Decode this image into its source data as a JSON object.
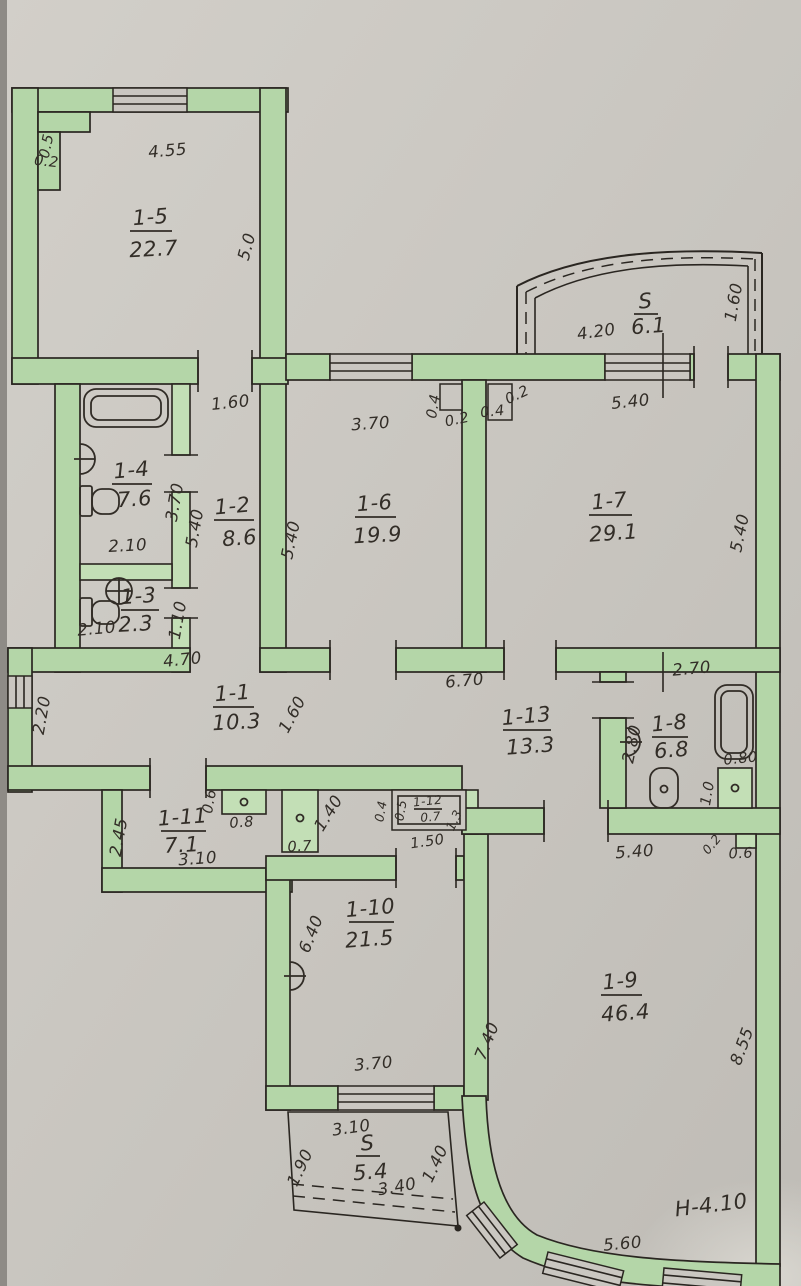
{
  "plan": {
    "type": "apartment-floor-plan",
    "note": "H-4.10",
    "colors": {
      "paper": "#cac7c1",
      "wall_green": "#b4d6a8",
      "ink": "#2a2621"
    }
  },
  "rooms": [
    {
      "id": "1-5",
      "area": "22.7"
    },
    {
      "id": "1-4",
      "area": "7.6"
    },
    {
      "id": "1-2",
      "area": "8.6"
    },
    {
      "id": "1-3",
      "area": "2.3"
    },
    {
      "id": "1-6",
      "area": "19.9"
    },
    {
      "id": "1-7",
      "area": "29.1"
    },
    {
      "id": "1-1",
      "area": "10.3"
    },
    {
      "id": "1-13",
      "area": "13.3"
    },
    {
      "id": "1-8",
      "area": "6.8"
    },
    {
      "id": "1-11",
      "area": "7.1"
    },
    {
      "id": "1-12",
      "area": "0.7"
    },
    {
      "id": "1-10",
      "area": "21.5"
    },
    {
      "id": "1-9",
      "area": "46.4"
    },
    {
      "id": "S",
      "area": "6.1"
    },
    {
      "id": "S",
      "area": "5.4"
    }
  ],
  "dims": [
    {
      "t": "4.55"
    },
    {
      "t": "0.5"
    },
    {
      "t": "0.2"
    },
    {
      "t": "5.0"
    },
    {
      "t": "1.60"
    },
    {
      "t": "3.70"
    },
    {
      "t": "0.4"
    },
    {
      "t": "0.2"
    },
    {
      "t": "0.4"
    },
    {
      "t": "0.2"
    },
    {
      "t": "4.20"
    },
    {
      "t": "1.60"
    },
    {
      "t": "5.40"
    },
    {
      "t": "5.40"
    },
    {
      "t": "3.70"
    },
    {
      "t": "5.40"
    },
    {
      "t": "2.10"
    },
    {
      "t": "2.10"
    },
    {
      "t": "1.10"
    },
    {
      "t": "5.40"
    },
    {
      "t": "4.70"
    },
    {
      "t": "2.20"
    },
    {
      "t": "1.60"
    },
    {
      "t": "6.70"
    },
    {
      "t": "2.70"
    },
    {
      "t": "2.80"
    },
    {
      "t": "0.80"
    },
    {
      "t": "1.0"
    },
    {
      "t": "0.6"
    },
    {
      "t": "0.8"
    },
    {
      "t": "2.45"
    },
    {
      "t": "3.10"
    },
    {
      "t": "1.40"
    },
    {
      "t": "0.7"
    },
    {
      "t": "0.5"
    },
    {
      "t": "1.3"
    },
    {
      "t": "0.4"
    },
    {
      "t": "1.50"
    },
    {
      "t": "6.40"
    },
    {
      "t": "3.70"
    },
    {
      "t": "7.40"
    },
    {
      "t": "5.40"
    },
    {
      "t": "0.2"
    },
    {
      "t": "0.6"
    },
    {
      "t": "8.55"
    },
    {
      "t": "5.60"
    },
    {
      "t": "3.10"
    },
    {
      "t": "3.40"
    },
    {
      "t": "1.90"
    },
    {
      "t": "1.40"
    }
  ],
  "notes": [
    {
      "t": "H-4.10"
    }
  ]
}
